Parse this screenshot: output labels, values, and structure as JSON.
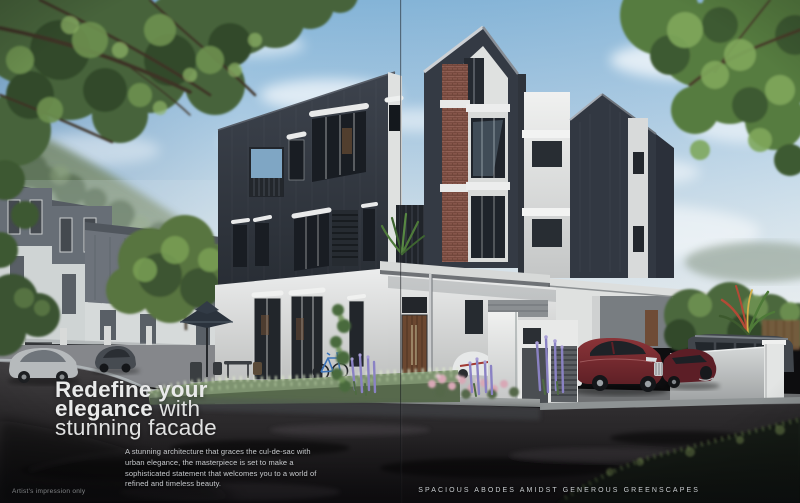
{
  "overlay": {
    "headline": {
      "line1": "Redefine your",
      "line2_strong": "elegance",
      "line2_rest": " with",
      "line3": "stunning facade"
    },
    "body_text": "A stunning architecture that graces the cul-de-sac with urban elegance, the masterpiece is set to make a sophisticated statement that welcomes you to a world of refined and timeless beauty.",
    "footer_caption": "SPACIOUS ABODES AMIDST GENEROUS GREENSCAPES",
    "disclaimer": "Artist's impression only"
  },
  "colors": {
    "sky_top": "#85b5d8",
    "sky_horizon": "#e6ebed",
    "facade_dark": "#333943",
    "facade_white": "#e6e7e6",
    "brick_accent": "#8a584c",
    "door_wood": "#6b4730",
    "foliage_green": "#47643a",
    "lavender": "#8a82c4",
    "car_red": "#7a2a30",
    "road_dark": "#1a191b",
    "headline_text": "#e9eaea",
    "caption_text": "#c9cdd0"
  }
}
